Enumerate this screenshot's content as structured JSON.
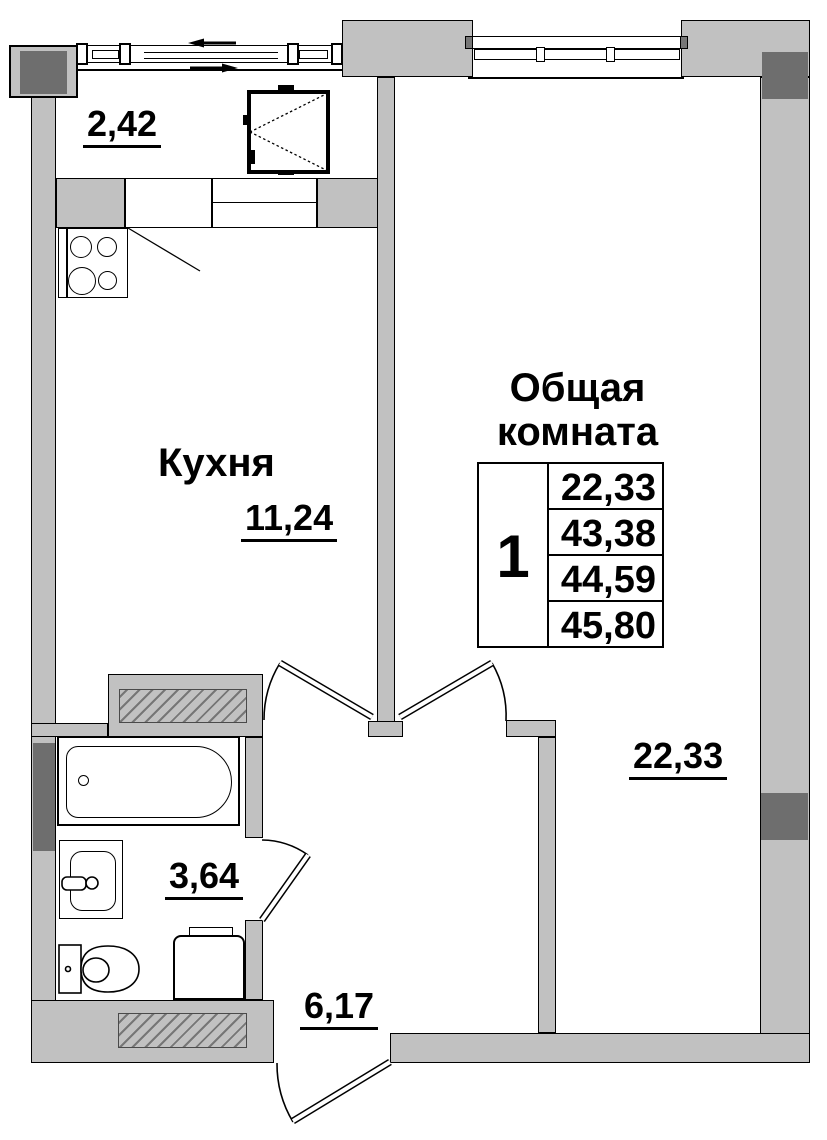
{
  "title": "Apartment floor plan, 1 room",
  "colors": {
    "wall": "#c1c1c1",
    "column": "#6e6e6e",
    "line": "#000000"
  },
  "labels": {
    "balcony_area": "2,42",
    "kitchen_name": "Кухня",
    "kitchen_area": "11,24",
    "living_name_line1": "Общая",
    "living_name_line2": "комната",
    "living_area": "22,33",
    "bathroom_area": "3,64",
    "hall_area": "6,17"
  },
  "summary_table": {
    "room_count": "1",
    "rows": [
      "22,33",
      "43,38",
      "44,59",
      "45,80"
    ]
  }
}
